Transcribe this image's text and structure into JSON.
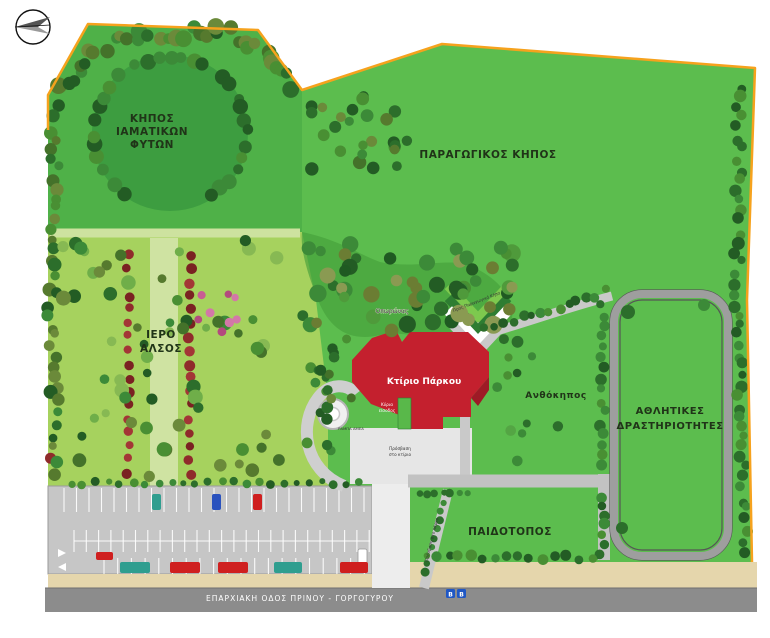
{
  "map": {
    "compass": {
      "icon": "north-arrow-icon"
    },
    "zones": {
      "medicinal_garden": {
        "name_lines": [
          "ΚΗΠΟΣ",
          "ΙΑΜΑΤΙΚΩΝ",
          "ΦΥΤΩΝ"
        ]
      },
      "productive_garden": {
        "name": "ΠΑΡΑΓΩΓΙΚΟΣ ΚΗΠΟΣ"
      },
      "sacred_grove": {
        "name_lines": [
          "ΙΕΡΟ",
          "ΑΛΣΟΣ"
        ]
      },
      "orchard": {
        "name": "Οπωρώνας"
      },
      "flower_garden": {
        "name": "Ανθόκηπος"
      },
      "sports_area": {
        "name_lines": [
          "ΑΘΛΗΤΙΚΕΣ",
          "ΔΡΑΣΤΗΡΙΟΤΗΤΕΣ"
        ]
      },
      "playground": {
        "name": "ΠΑΙΔΟΤΟΠΟΣ"
      }
    },
    "building": {
      "name": "Κτίριο Πάρκου",
      "entrance_lines": [
        "Κύρια",
        "είσοδος"
      ]
    },
    "annotations": {
      "ramp": "ΡΑΜΠΑ ΑΜΕΑ",
      "building_access_lines": [
        "Πρόσβαση",
        "στο κτίριο"
      ],
      "path_note_upper": "Προς Παραγωγικό Κήπο",
      "path_note_lower": "Πρόσβαση στο πάρκο"
    },
    "road": {
      "name": "ΕΠΑΡΧΙΑΚΗ ΟΔΟΣ ΠΡΙΝΟΥ - ΓΟΡΓΟΓΥΡΟΥ"
    },
    "bus_stop": {
      "label": "B",
      "icon": "bus-stop-icon"
    },
    "colors": {
      "park_green": "#5cbd4e",
      "grove_green": "#a6d25e",
      "medicinal_green": "#4fb148",
      "circle_green": "#3d9d40",
      "building_red": "#c4202e",
      "boundary_orange": "#f6a21d",
      "path_gray": "#c9c9c9",
      "road_gray": "#8c8c8c",
      "sidewalk_beige": "#e5d6ac",
      "parking_gray": "#c6c6c6",
      "track_gray": "#9e9e9e",
      "red_tree": "#8f2b2b",
      "bus_blue": "#1f57c4"
    }
  }
}
